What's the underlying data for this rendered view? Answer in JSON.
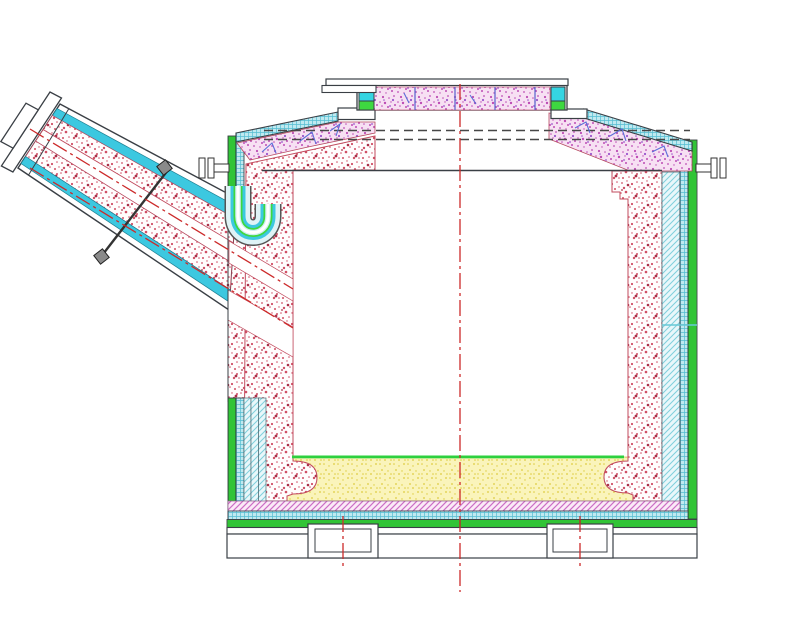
{
  "drawing": {
    "kind": "engineering-cross-section",
    "components": [
      "tapered-spout-launder",
      "spout-flange",
      "spout-tie-bolt",
      "vessel-left-wall",
      "vessel-right-wall",
      "roof-left-slope",
      "roof-right-slope",
      "removable-lid",
      "lid-end-blocks",
      "hearth-bottom",
      "bottom-insulation-stack",
      "base-frame",
      "support-foot-left",
      "support-foot-right",
      "anchor-bolt-left",
      "anchor-bolt-right",
      "channel-elbow-lining",
      "hidden-opening-lines",
      "vertical-centerline"
    ],
    "support_feet_count": 2,
    "lid_block_divider_count": 4,
    "palette": {
      "line_dark": "#3a3f45",
      "line_red": "#c14b5e",
      "centerline_red": "#cc2a2a",
      "hidden_line": "#474747",
      "steel_white": "#ffffff",
      "solid_cyan": "#3cc8e0",
      "lid_cyan": "#35d5e2",
      "green_bg": "#3ed840",
      "green_stripe": "#18a022",
      "cyan_grid_bg": "#bfe9f0",
      "cyan_grid_line": "#54bdd2",
      "hatch_bg": "#e9f7fa",
      "hatch_line": "#7fd0dc",
      "pink_hatch_bg": "#fbeaf7",
      "pink_hatch_line": "#cc6ec6",
      "refractory_bg": "#fffdfd",
      "refractory_dot": "#d04f66",
      "refractory_dot_dark": "#aa3048",
      "roof_brick_bg": "#f7e0f3",
      "roof_brick_dot": "#bd4cb4",
      "roof_brick_dot2": "#9a55cc",
      "hearth_bg": "#faf4bb",
      "hearth_dot": "#ddcc3f",
      "hearth_top_line": "#2ed03e",
      "joint_blue": "#5b6fd8",
      "lid_joint_blue": "#5560cc",
      "seam_cyan": "#66c8d6",
      "hook_pale": "#dff3f6",
      "hook_core": "#cfeef2"
    }
  }
}
